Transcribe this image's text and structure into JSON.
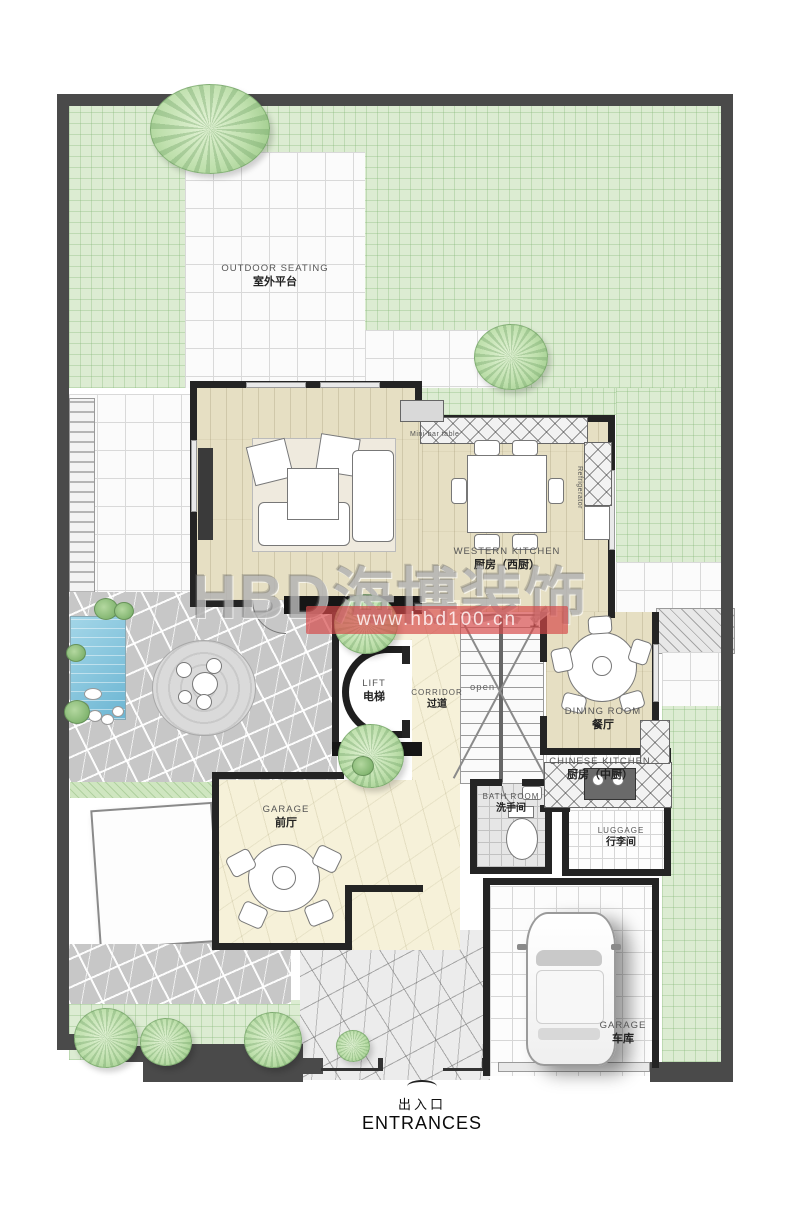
{
  "watermark": {
    "brand": "HBD海博装饰",
    "url": "www.hbd100.cn"
  },
  "entrance": {
    "zh": "出入口",
    "en": "ENTRANCES"
  },
  "rooms": {
    "outdoor_seating": {
      "en": "OUTDOOR SEATING",
      "zh": "室外平台"
    },
    "western_kitchen": {
      "en": "WESTERN KITCHEN",
      "zh": "厨房（西厨）"
    },
    "dining_room": {
      "en": "DINING ROOM",
      "zh": "餐厅"
    },
    "chinese_kitchen": {
      "en": "CHINESE KITCHEN",
      "zh": "厨房（中厨）"
    },
    "luggage": {
      "en": "LUGGAGE",
      "zh": "行李间"
    },
    "bathroom": {
      "en": "BATH ROOM",
      "zh": "洗手间"
    },
    "lift": {
      "en": "LIFT",
      "zh": "电梯"
    },
    "corridor": {
      "en": "CORRIDOR",
      "zh": "过道"
    },
    "front_hall": {
      "en": "GARAGE",
      "zh": "前厅"
    },
    "garage": {
      "en": "GARAGE",
      "zh": "车库"
    }
  },
  "annotations": {
    "mini_bar": "Mini-bar table",
    "refrigerator": "Refrigerator",
    "stair_open": "open",
    "stair_up": "上"
  },
  "colors": {
    "lawn": "#dcecd2",
    "lawn_hatch": "#a5cc97",
    "wood_floor": "#e6dfc3",
    "marble_floor": "#f6f1d9",
    "tile": "#fbfbfb",
    "stone_paving": "#c7c7c7",
    "pool_water": "#8cc8de",
    "wall": "#242424",
    "site_frame": "#4a4a4a",
    "watermark_red": "#d64848",
    "tree_green": "#bfe0ad"
  }
}
